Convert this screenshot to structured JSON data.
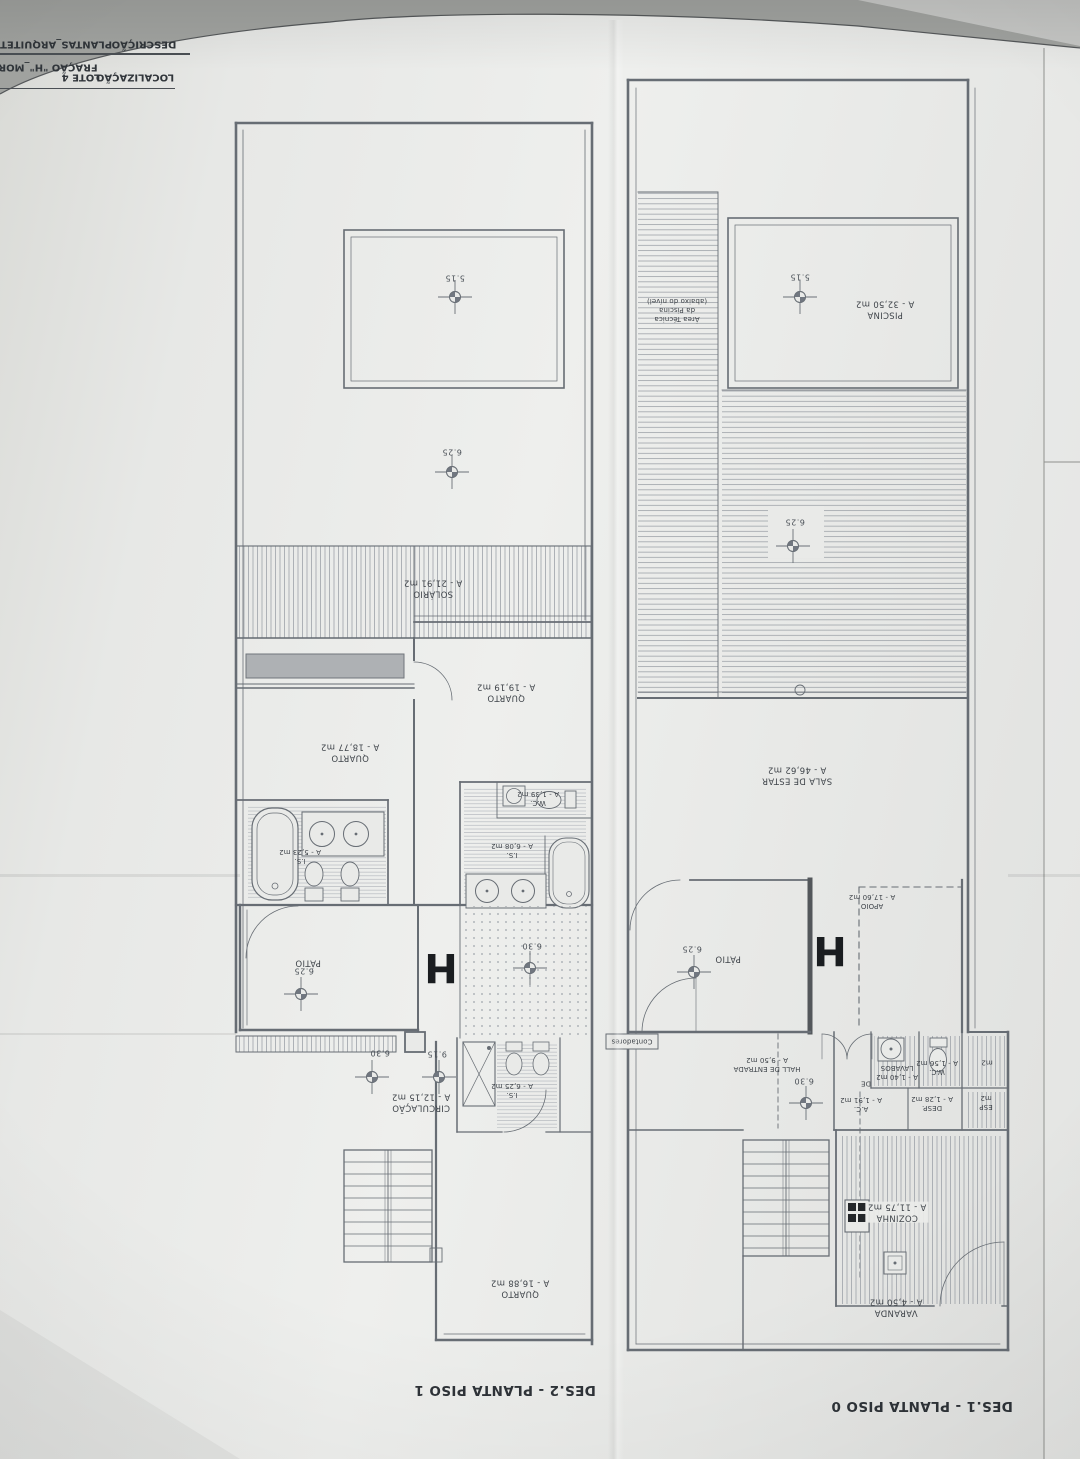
{
  "colors": {
    "paper": "#e9eae8",
    "line": "#676d74",
    "text": "#3f444a",
    "background": "#a1a3a0",
    "wall_dark": "#53575b"
  },
  "title_block": {
    "descricao_label": "DESCRIÇÃO",
    "descricao_value": "PLANTAS_ARQUITETU",
    "localizacao_label": "LOCALIZAÇÃO",
    "localizacao_value": "LOTE 4",
    "fracao_value": "FRAÇÃO \"H\"_MORAD"
  },
  "p1": {
    "caption": "DES.2 - PLANTA PISO 1",
    "h": "H",
    "levels": {
      "deck_top": "5.15",
      "deck": "6.25",
      "patio": "6.25",
      "court": "6.30",
      "circ": "6.30",
      "stair": "9.15"
    },
    "solario": {
      "n": "SOLÁRIO",
      "a": "A - 21,91 m2"
    },
    "quarto1": {
      "n": "QUARTO",
      "a": "A - 19,19 m2"
    },
    "quarto2": {
      "n": "QUARTO",
      "a": "A - 18,77 m2"
    },
    "quarto3": {
      "n": "QUARTO",
      "a": "A - 16,88 m2"
    },
    "is1": {
      "n": "I.S.",
      "a": "A - 5,23 m2"
    },
    "is2": {
      "n": "I.S.",
      "a": "A - 6,08 m2"
    },
    "is3": {
      "n": "I.S.",
      "a": "A - 6,25 m2"
    },
    "wc": {
      "n": "W.C.",
      "a": "A - 1,39 m2"
    },
    "circ": {
      "n": "CIRCULAÇÃO",
      "a": "A - 12,15 m2"
    },
    "patio": {
      "n": "PÁTIO"
    }
  },
  "p0": {
    "caption": "DES.1 - PLANTA PISO 0",
    "h": "H",
    "levels": {
      "piscina": "5.15",
      "deck": "6.25",
      "patio": "6.25",
      "hall": "6.30"
    },
    "piscina": {
      "n": "PISCINA",
      "a": "A - 32,50 m2"
    },
    "area_tecnica": {
      "l1": "Área Técnica",
      "l2": "da Piscina",
      "l3": "(abaixo do nível)"
    },
    "sala": {
      "n": "SALA DE ESTAR",
      "a": "A - 46,62 m2"
    },
    "apoio": {
      "n": "APOIO",
      "a": "A - 17,60 m2"
    },
    "patio": {
      "n": "PÁTIO"
    },
    "contadores": {
      "n": "Contadores"
    },
    "hall": {
      "n": "HALL DE ENTRADA",
      "a": "A - 9,50 m2"
    },
    "lavabos": {
      "n": "LAVABOS",
      "a": "A - 1,40 m2"
    },
    "wc": {
      "n": "W.C.",
      "a": "A - 1,56 m2"
    },
    "desp": {
      "n": "DESP.",
      "a": "A - 1,28 m2"
    },
    "ac": {
      "n": "A.C.",
      "a": "A - 1,91 m2"
    },
    "de": {
      "n": "DE"
    },
    "cozinha": {
      "n": "COZINHA",
      "a": "A - 11,75 m2"
    },
    "varanda": {
      "n": "VARANDA",
      "a": "A - 4,50 m2"
    },
    "edge1": {
      "a": "m2"
    },
    "edge2": {
      "n": "ESP",
      "a": "m2"
    }
  }
}
